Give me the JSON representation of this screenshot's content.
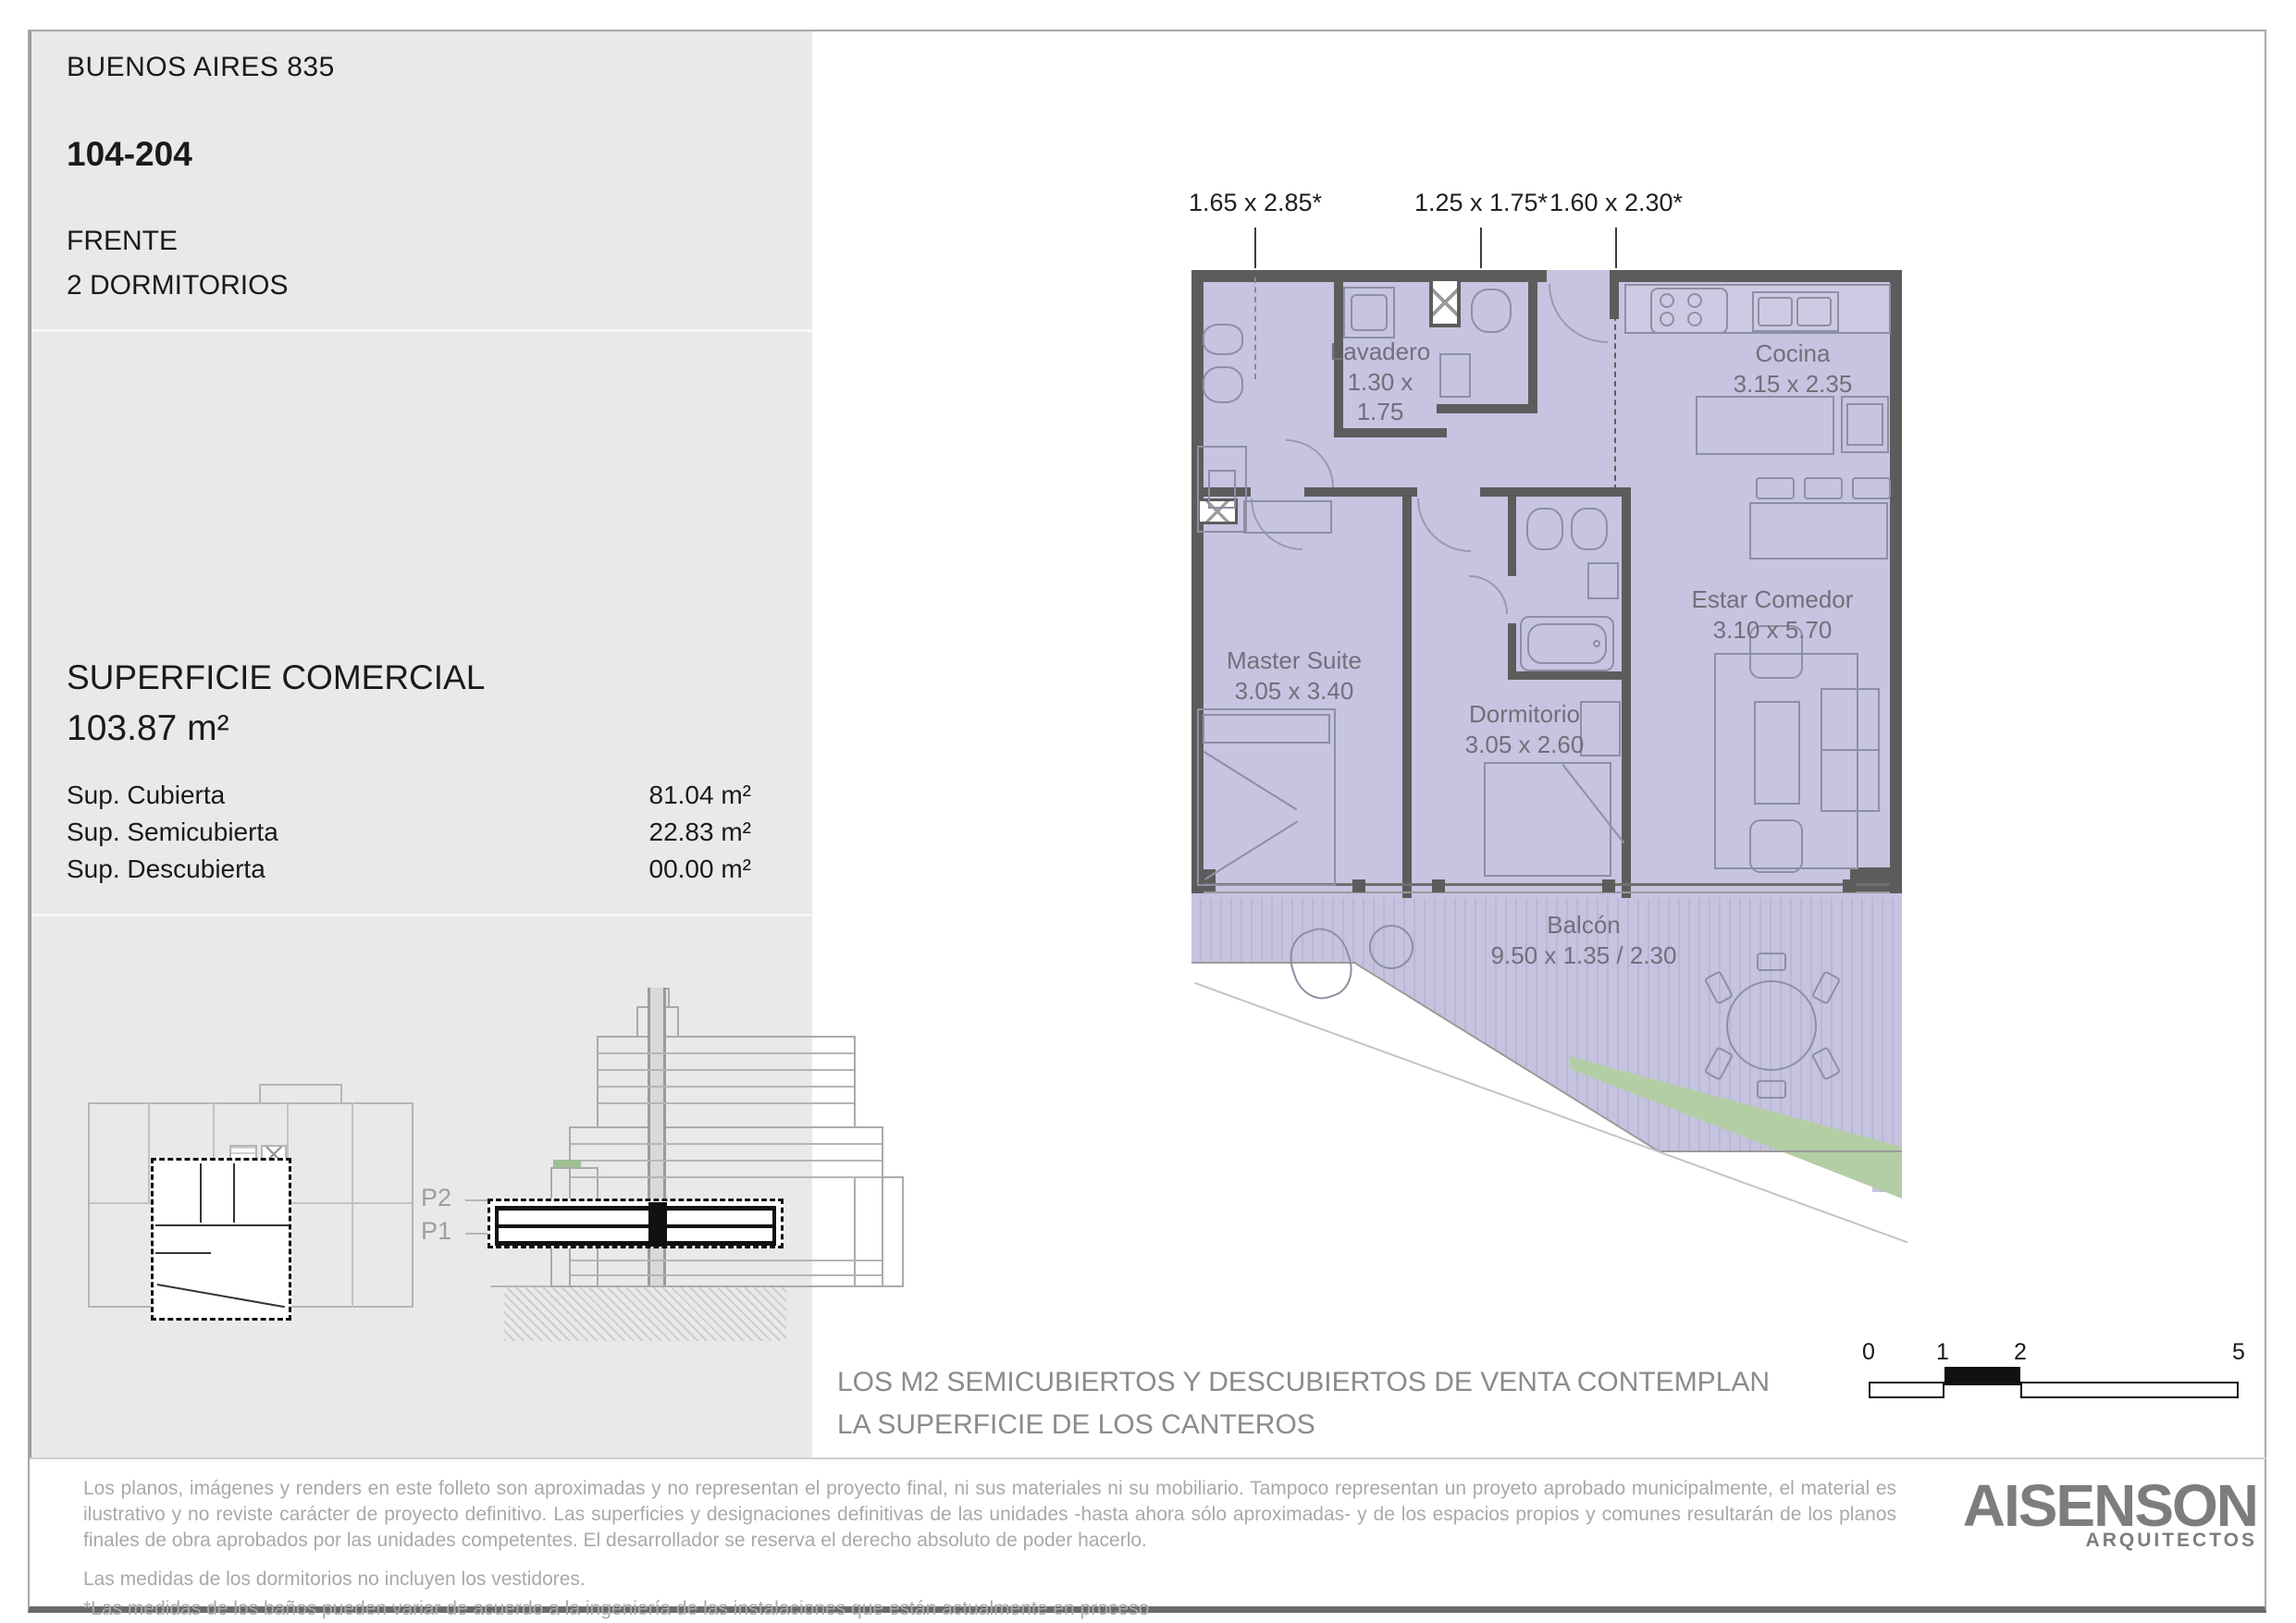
{
  "header": {
    "project": "BUENOS AIRES 835",
    "unit": "104-204",
    "orientation": "FRENTE",
    "typology": "2 DORMITORIOS"
  },
  "superficie": {
    "title": "SUPERFICIE COMERCIAL",
    "total": "103.87 m²",
    "rows": [
      {
        "label": "Sup. Cubierta",
        "value": "81.04 m²"
      },
      {
        "label": "Sup. Semicubierta",
        "value": "22.83 m²"
      },
      {
        "label": "Sup. Descubierta",
        "value": "00.00 m²"
      }
    ]
  },
  "plan": {
    "dimension_labels": [
      "1.65 x 2.85*",
      "1.25 x 1.75*",
      "1.60 x 2.30*"
    ],
    "rooms": [
      {
        "name": "Lavadero",
        "dims": "1.30 x 1.75"
      },
      {
        "name": "Cocina",
        "dims": "3.15 x 2.35"
      },
      {
        "name": "Master Suite",
        "dims": "3.05 x 3.40"
      },
      {
        "name": "Dormitorio",
        "dims": "3.05 x 2.60"
      },
      {
        "name": "Estar Comedor",
        "dims": "3.10 x 5.70"
      },
      {
        "name": "Balcón",
        "dims": "9.50 x 1.35 / 2.30"
      }
    ]
  },
  "section_labels": {
    "p2": "P2",
    "p1": "P1"
  },
  "note": {
    "line1": "LOS M2 SEMICUBIERTOS Y DESCUBIERTOS DE VENTA CONTEMPLAN",
    "line2": "LA SUPERFICIE DE LOS CANTEROS"
  },
  "scale_bar": {
    "ticks": [
      "0",
      "1",
      "2",
      "5"
    ]
  },
  "disclaimer": {
    "p1": "Los planos, imágenes y renders en este folleto son aproximadas y no representan el proyecto final, ni sus materiales ni su mobiliario. Tampoco representan un proyeto aprobado municipalmente, el material es ilustrativo y no reviste carácter de proyecto definitivo. Las superficies y designaciones definitivas de las unidades -hasta ahora sólo aproximadas- y de los espacios propios y comunes resultarán de los planos finales de obra aprobados por las unidades competentes. El desarrollador se reserva el derecho absoluto de poder hacerlo.",
    "p2": "Las medidas de los dormitorios no incluyen los vestidores.",
    "p3": "*Las medidas de los baños pueden variar de acuerdo a la ingeniería de las instalaciones que están actualmente en proceso"
  },
  "logo": {
    "name": "AISENSON",
    "sub": "ARQUITECTOS"
  },
  "colors": {
    "plan_fill": "#c6c4e0",
    "wall": "#5c5c5c",
    "balcony_green": "#b3cea5",
    "sidebar_bg": "#e9e9e9",
    "note_gray": "#8b8b8b",
    "disclaimer_gray": "#a9a9a9",
    "logo_gray": "#7d7d7d"
  }
}
